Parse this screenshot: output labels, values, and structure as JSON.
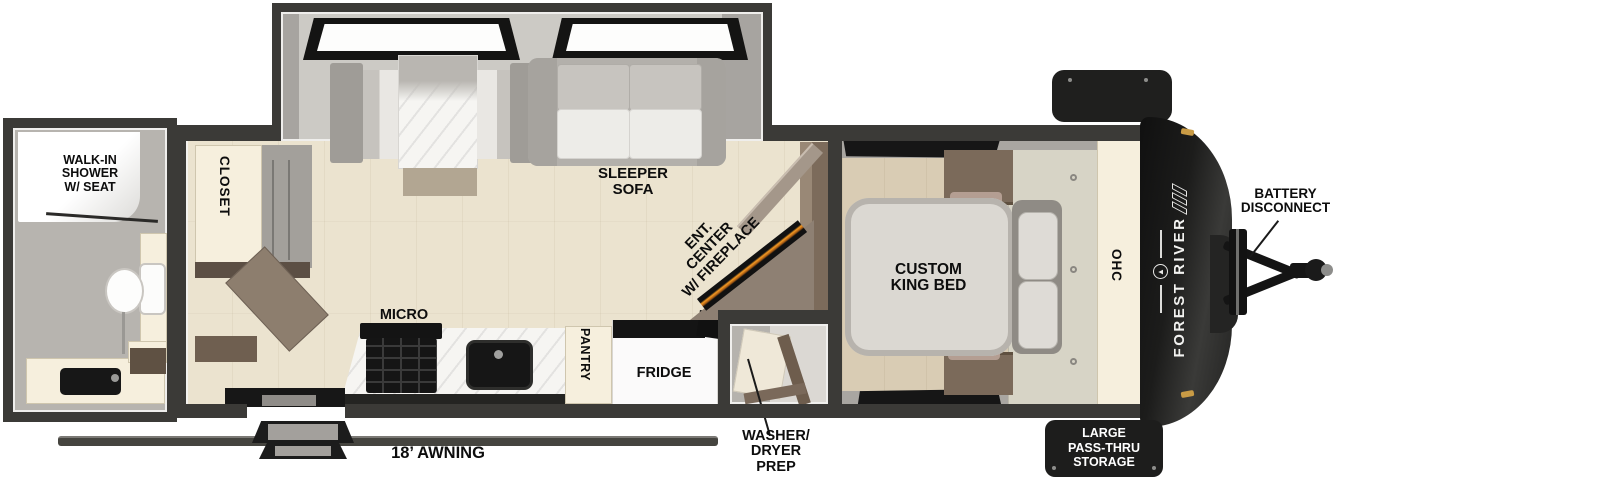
{
  "diagram_type": "rv-travel-trailer-floorplan",
  "brand": {
    "name": "FOREST RIVER",
    "logo": "tree-in-circle-emblem",
    "stripes_icon": "three-slash-stripes"
  },
  "labels": {
    "shower": {
      "l1": "WALK-IN",
      "l2": "SHOWER",
      "l3": "W/ SEAT"
    },
    "closet": "CLOSET",
    "sleeper": {
      "l1": "SLEEPER",
      "l2": "SOFA"
    },
    "ent": {
      "l1": "ENT.",
      "l2": "CENTER",
      "l3": "W/ FIREPLACE"
    },
    "micro": "MICRO",
    "pantry": "PANTRY",
    "fridge": "FRIDGE",
    "washer": {
      "l1": "WASHER/",
      "l2": "DRYER",
      "l3": "PREP"
    },
    "awning": "18’ AWNING",
    "bed": {
      "l1": "CUSTOM",
      "l2": "KING BED"
    },
    "ohc": "OHC",
    "battery": {
      "l1": "BATTERY",
      "l2": "DISCONNECT"
    },
    "storage": {
      "l1": "LARGE",
      "l2": "PASS-THRU",
      "l3": "STORAGE"
    }
  },
  "colors": {
    "wall": "#3b3a37",
    "floor_main": "#ebe3cf",
    "floor_bedroom": "#d9ccb4",
    "floor_slide": "#cccac5",
    "floor_bath": "#b7b4af",
    "cabinet_cream": "#f6efdd",
    "wood_brown": "#7b6a5a",
    "appliance_black": "#171717",
    "fireplace_orange": "#f59a23",
    "front_cap_black": "#1d1d1c",
    "label_text": "#0d0d0d",
    "storage_label_text": "#ffffff",
    "clearance_light_gold": "#c99b45"
  }
}
